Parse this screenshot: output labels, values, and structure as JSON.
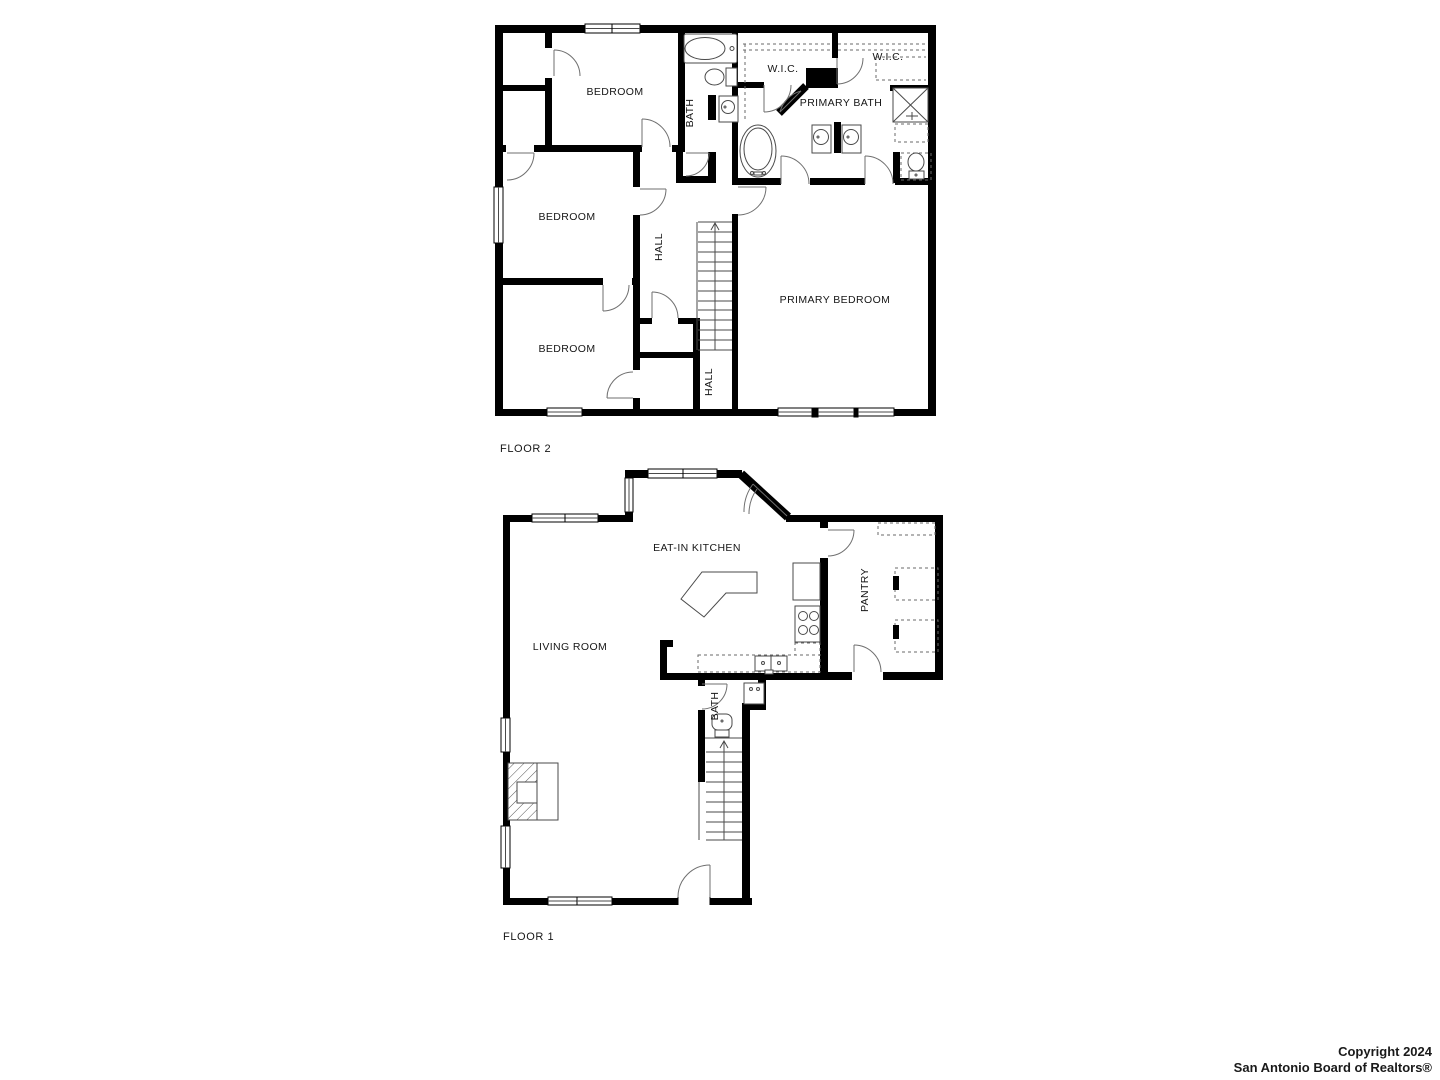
{
  "floor2": {
    "label": "FLOOR 2",
    "rooms": {
      "bedroom_top": "BEDROOM",
      "bedroom_mid": "BEDROOM",
      "bedroom_bottom": "BEDROOM",
      "bath": "BATH",
      "hall_upper": "HALL",
      "hall_lower": "HALL",
      "wic_left": "W.I.C.",
      "wic_right": "W.I.C.",
      "primary_bath": "PRIMARY BATH",
      "primary_bedroom": "PRIMARY BEDROOM"
    }
  },
  "floor1": {
    "label": "FLOOR 1",
    "rooms": {
      "eat_in_kitchen": "EAT-IN KITCHEN",
      "living_room": "LIVING ROOM",
      "pantry": "PANTRY",
      "bath": "BATH"
    }
  },
  "copyright": {
    "line1": "Copyright 2024",
    "line2": "San Antonio Board of Realtors®"
  },
  "colors": {
    "wall": "#000000",
    "background": "#ffffff"
  }
}
